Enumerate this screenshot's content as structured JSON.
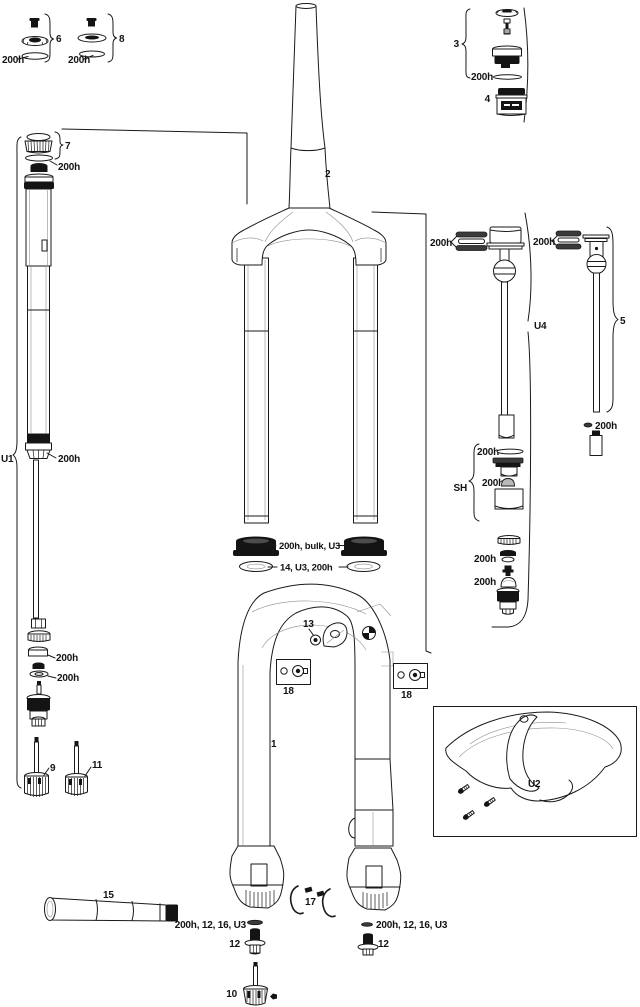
{
  "figure": {
    "background": "#ffffff",
    "line_color": "#1a1a1a",
    "seal_color": "#141414"
  },
  "labels": {
    "h200": "200h",
    "item1": "1",
    "item2": "2",
    "item3": "3",
    "item4": "4",
    "item5": "5",
    "item6": "6",
    "item7": "7",
    "item8": "8",
    "item9": "9",
    "item10": "10",
    "item11": "11",
    "item12": "12",
    "item13": "13",
    "item15": "15",
    "item17": "17",
    "item18": "18",
    "groupU1": "U1",
    "groupU2": "U2",
    "groupU4": "U4",
    "groupSH": "SH",
    "noteDustSeal": "200h, bulk, U3",
    "noteFoamRing": "14, U3, 200h",
    "noteCrushWasher": "200h, 12, 16, U3"
  }
}
